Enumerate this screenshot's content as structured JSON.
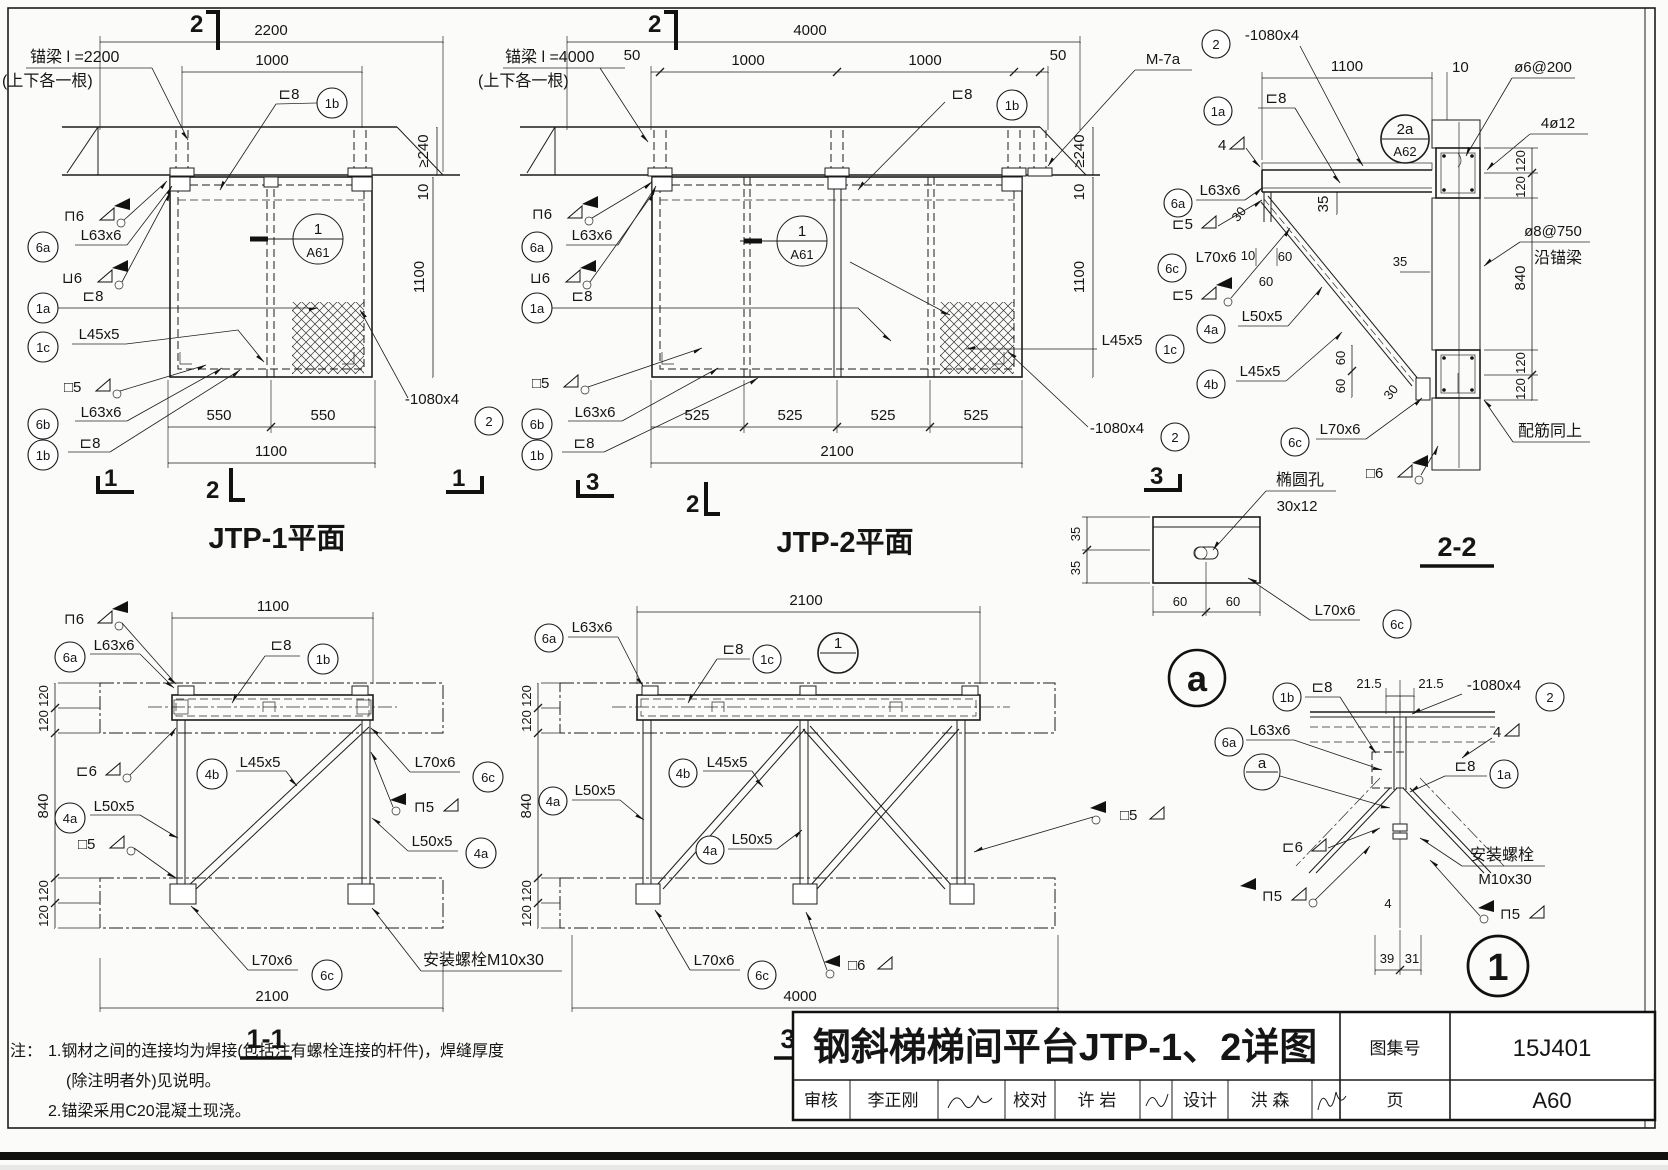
{
  "titles": {
    "jtp1": "JTP-1平面",
    "jtp2": "JTP-2平面",
    "s11": "1-1",
    "s22": "2-2",
    "s33": "3-3"
  },
  "marks": {
    "m1": "1",
    "m2": "2",
    "m3": "3"
  },
  "tags": {
    "t1a": "1a",
    "t1b": "1b",
    "t1c": "1c",
    "t2": "2",
    "t4a": "4a",
    "t4b": "4b",
    "t6a": "6a",
    "t6b": "6b",
    "t6c": "6c"
  },
  "details": {
    "a61_num": "1",
    "a61_ref": "A61",
    "a62_num": "2a",
    "a62_ref": "A62",
    "ref1_num": "1",
    "refa_num": "a",
    "big_a": "a",
    "big_1": "1"
  },
  "parts": {
    "c8": "⊏8",
    "l63": "L63x6",
    "l45": "L45x5",
    "l50": "L50x5",
    "l70": "L70x6",
    "plate": "-1080x4",
    "m7a": "M-7a"
  },
  "welds": {
    "top6": "⊓6",
    "bot6": "⊔6",
    "box5": "□5",
    "left6": "⊏6",
    "left5": "⊏5",
    "box6": "□6",
    "cap5": "⊓5",
    "w4": "4"
  },
  "dims": {
    "d4": "4",
    "d10": "10",
    "d215": "21.5",
    "d30": "30",
    "d31": "31",
    "d35": "35",
    "d39": "39",
    "d50": "50",
    "d60": "60",
    "d120": "120",
    "d240": "≥240",
    "d525": "525",
    "d550": "550",
    "d840": "840",
    "d1000": "1000",
    "d1100": "1100",
    "d2100": "2100",
    "d2200": "2200",
    "d4000": "4000"
  },
  "anchors": {
    "jtp1_line1": "锚梁 l =2200",
    "jtp2_line1": "锚梁 l =4000",
    "line2": "(上下各一根)"
  },
  "rebar": {
    "phi6": "ø6@200",
    "four12": "4ø12",
    "phi8": "ø8@750",
    "along": "沿锚梁",
    "same": "配筋同上"
  },
  "hole": {
    "name": "椭圆孔",
    "size": "30x12"
  },
  "bolt": {
    "full": "安装螺栓M10x30",
    "name": "安装螺栓",
    "spec": "M10x30"
  },
  "notes": {
    "prefix": "注：",
    "line1": "1.钢材之间的连接均为焊接(包括注有螺栓连接的杆件)，焊缝厚度",
    "line2": "(除注明者外)见说明。",
    "line3": "2.锚梁采用C20混凝土现浇。"
  },
  "titleblock": {
    "title": "钢斜梯梯间平台JTP-1、2详图",
    "atlas_label": "图集号",
    "atlas_no": "15J401",
    "page_label": "页",
    "page_no": "A60",
    "review_label": "审核",
    "review_name": "李正刚",
    "check_label": "校对",
    "check_name": "许 岩",
    "design_label": "设计",
    "design_name": "洪 森"
  }
}
